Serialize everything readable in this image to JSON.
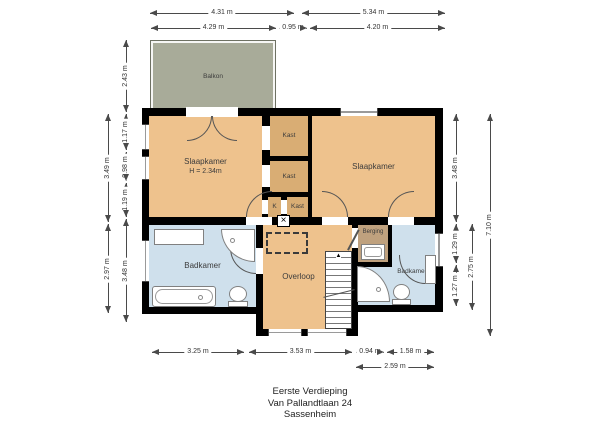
{
  "title": {
    "line1": "Eerste Verdieping",
    "line2": "Van Pallandtlaan 24",
    "line3": "Sassenheim"
  },
  "rooms": {
    "balkon": {
      "label": "Balkon"
    },
    "slaapkamer_left": {
      "label": "Slaapkamer",
      "height_note": "H = 2.34m"
    },
    "kast_top": {
      "label": "Kast"
    },
    "kast_mid": {
      "label": "Kast"
    },
    "k": {
      "label": "K"
    },
    "kast_bot": {
      "label": "Kast"
    },
    "slaapkamer_right": {
      "label": "Slaapkamer"
    },
    "badkamer_left": {
      "label": "Badkamer"
    },
    "overloop": {
      "label": "Overloop"
    },
    "berging": {
      "label": "Berging"
    },
    "badkamer_right": {
      "label": "Badkamer"
    }
  },
  "dims": {
    "t431": "4.31 m",
    "t534": "5.34 m",
    "t429": "4.29 m",
    "t095": "0.95 m",
    "t420": "4.20 m",
    "l243": "2.43 m",
    "l349": "3.49 m",
    "l297": "2.97 m",
    "l117": "1.17 m",
    "l098": "0.98 m",
    "l119": "1.19 m",
    "l348": "3.48 m",
    "r348": "3.48 m",
    "r129": "1.29 m",
    "r127": "1.27 m",
    "r275": "2.75 m",
    "r710": "7.10 m",
    "b325": "3.25 m",
    "b353": "3.53 m",
    "b094": "0.94 m",
    "b158": "1.58 m",
    "b259": "2.59 m"
  },
  "icons": {
    "shaft_x": "×",
    "stair_up_arrow": "▲"
  },
  "colors": {
    "room_tan": "#eec28d",
    "closet_tan": "#d9ad74",
    "bath_blue": "#cfe0ec",
    "storage_brown": "#bfa17e",
    "balcony_green": "#a8ab99",
    "wall_black": "#000000"
  }
}
